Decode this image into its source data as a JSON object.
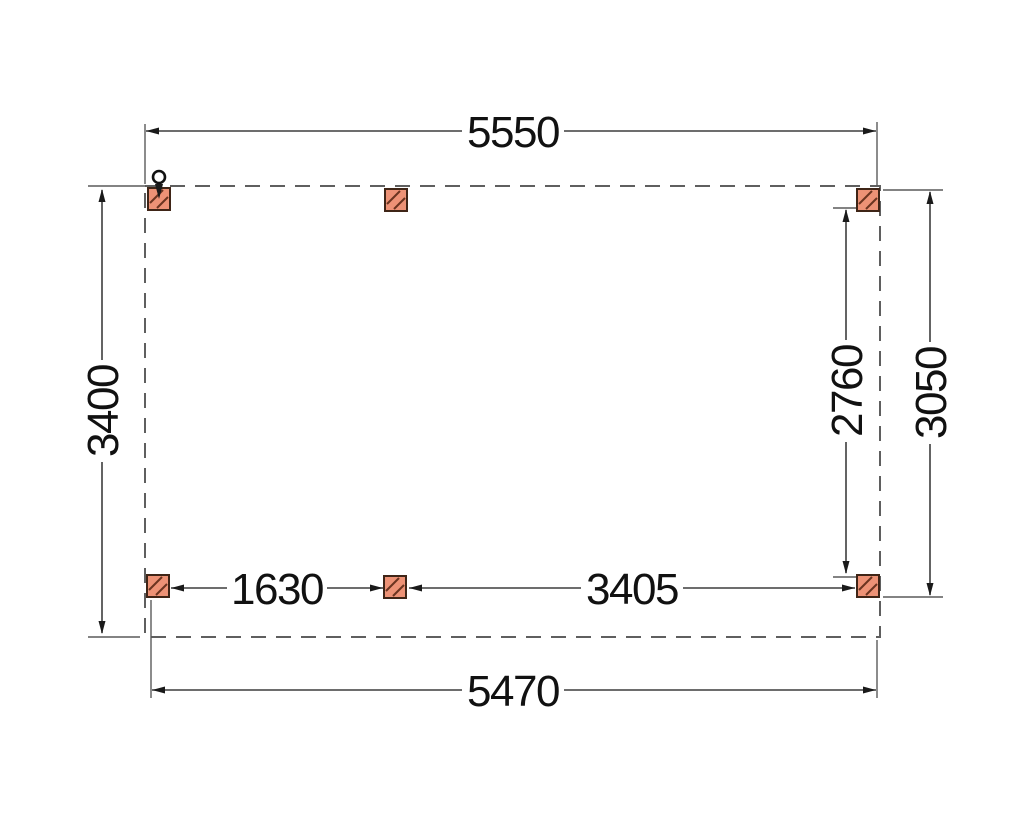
{
  "drawing": {
    "type": "technical-floor-plan",
    "dimensions": {
      "top_width": "5550",
      "bottom_width": "5470",
      "left_height": "3400",
      "right_post_span": "2760",
      "right_height": "3050",
      "bottom_left_bay": "1630",
      "bottom_right_bay": "3405"
    },
    "colors": {
      "background": "#FFFFFF",
      "post_fill": "#ED9276",
      "post_border": "#3F2517",
      "post_hatch": "#6B3420",
      "outline_dash": "#5F5F5F",
      "dimension_line": "#3D3D3D",
      "text": "#111111"
    },
    "elements": {
      "posts_count": 6,
      "marker": "downpipe-circle-top-left"
    }
  }
}
